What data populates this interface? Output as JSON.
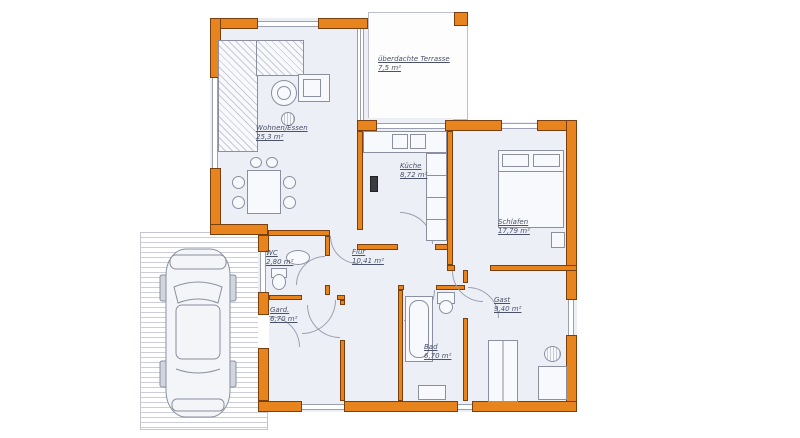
{
  "plan_title": "Einfamilienhaus Grundriss",
  "palette": {
    "wall": "#E8841E",
    "wallb": "#7A3F0E",
    "floor": "#EDEFF6",
    "line": "#9AA0B0",
    "label": "#4A5268"
  },
  "rooms": [
    {
      "id": "wohnen",
      "name": "Wohnen/Essen",
      "area": "25,3 m²"
    },
    {
      "id": "terrasse",
      "name": "überdachte Terrasse",
      "area": "7,5 m²"
    },
    {
      "id": "kueche",
      "name": "Küche",
      "area": "8,72 m²"
    },
    {
      "id": "schlafen",
      "name": "Schlafen",
      "area": "17,79 m²"
    },
    {
      "id": "flur",
      "name": "Flur",
      "area": "10,41 m²"
    },
    {
      "id": "wc",
      "name": "WC",
      "area": "2,80 m²"
    },
    {
      "id": "gard",
      "name": "Gard.",
      "area": "6,70 m²"
    },
    {
      "id": "bad",
      "name": "Bad",
      "area": "6,70 m²"
    },
    {
      "id": "gast",
      "name": "Gast",
      "area": "9,40 m²"
    }
  ],
  "features": {
    "icons": [
      "car-top-view-icon",
      "corner-sofa-icon",
      "coffee-table-icon",
      "plant-icon",
      "tv-board-icon",
      "dining-table-icon",
      "kitchen-counter-icon",
      "sink-icon",
      "double-bed-icon",
      "bathtub-icon",
      "toilet-icon",
      "wardrobe-icon",
      "desk-icon",
      "chimney-icon"
    ]
  }
}
